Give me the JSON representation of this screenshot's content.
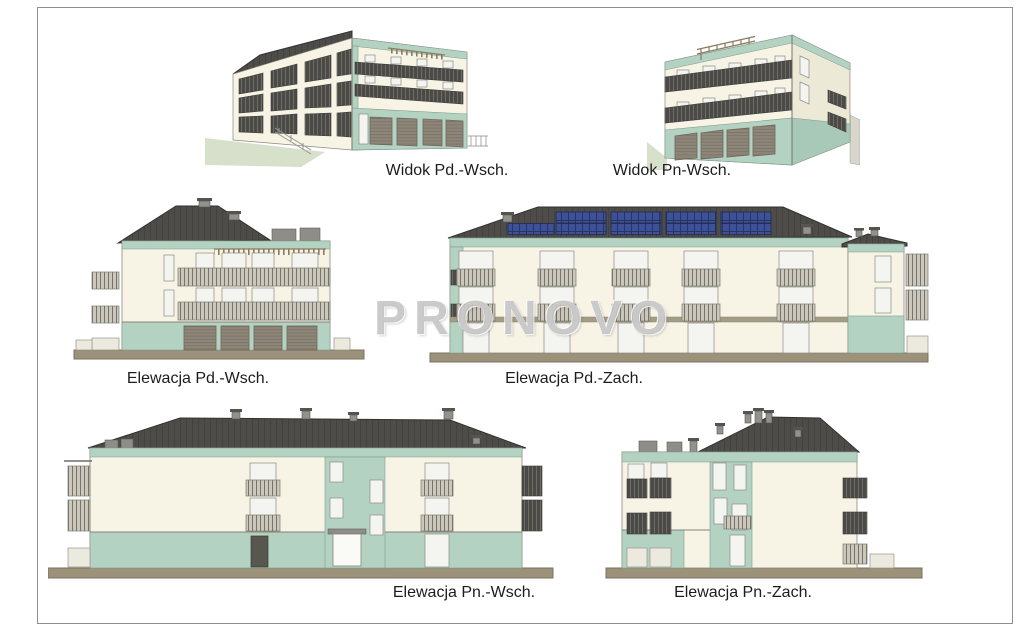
{
  "sheet": {
    "type": "architectural-elevation-sheet",
    "watermark": "PRONOVO"
  },
  "views": [
    {
      "id": "widok-pd-wsch",
      "kind": "perspective-view",
      "label": "Widok Pd.-Wsch."
    },
    {
      "id": "widok-pn-wsch",
      "kind": "perspective-view",
      "label": "Widok Pn-Wsch."
    },
    {
      "id": "elewacja-pd-wsch",
      "kind": "elevation",
      "label": "Elewacja Pd.-Wsch."
    },
    {
      "id": "elewacja-pd-zach",
      "kind": "elevation",
      "label": "Elewacja Pd.-Zach.",
      "features": [
        "solar-panels"
      ]
    },
    {
      "id": "elewacja-pn-wsch",
      "kind": "elevation",
      "label": "Elewacja Pn.-Wsch."
    },
    {
      "id": "elewacja-pn-zach",
      "kind": "elevation",
      "label": "Elewacja Pn.-Zach."
    }
  ],
  "palette": {
    "wall-cream": "#f7f4e6",
    "wall-cream-shade": "#ece9d7",
    "wall-mint": "#b4d2c2",
    "wall-mint-dark": "#a9c9b8",
    "roof-gray": "#4d4c48",
    "ground-strip": "#9c9279",
    "garage-door": "#8e8779",
    "railing-light": "#cbc7ba",
    "railing-dark": "#4b4a46",
    "glass": "#f4f5f0",
    "solar-panel": "#3e5197",
    "grass": "#d6e0ca",
    "pergola-wood": "#8a7a5f",
    "caption-text": "#1c1c1c",
    "watermark-gray": "#9e9e9e"
  }
}
